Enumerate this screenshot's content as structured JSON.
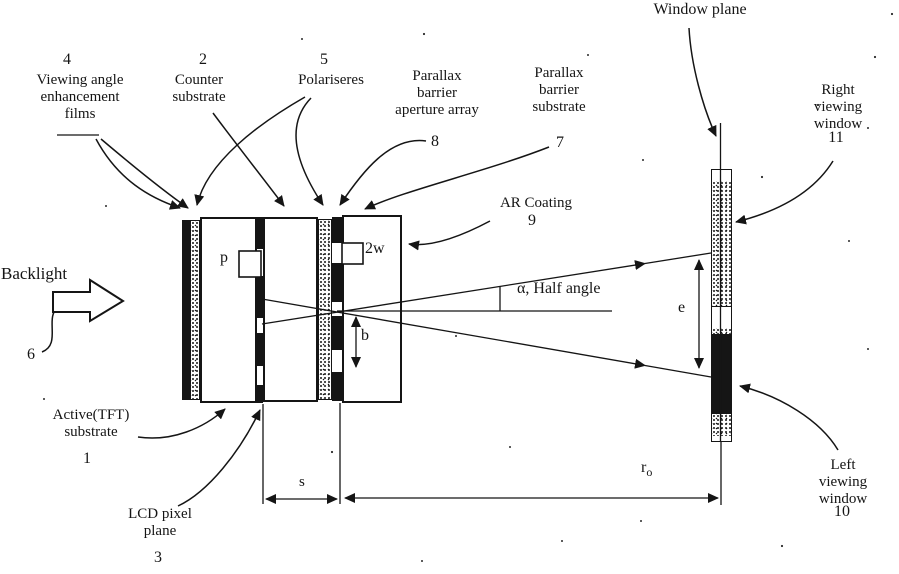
{
  "diagram": {
    "type": "patent-style optical diagram of parallax-barrier 3D display",
    "labels": {
      "window_plane": {
        "text": "Window plane"
      },
      "films": {
        "num": "4",
        "text": "Viewing angle\nenhancement\nfilms"
      },
      "counter_substrate": {
        "num": "2",
        "text": "Counter\nsubstrate"
      },
      "polarisers": {
        "num": "5",
        "text": "Polariseres"
      },
      "aperture_array": {
        "num": "8",
        "text": "Parallax\nbarrier\naperture array"
      },
      "barrier_substrate": {
        "num": "7",
        "text": "Parallax\nbarrier\nsubstrate"
      },
      "ar_coating": {
        "num": "9",
        "text": "AR Coating"
      },
      "right_window": {
        "num": "11",
        "text": "Right viewing\nwindow"
      },
      "left_window": {
        "num": "10",
        "text": "Left viewing\nwindow"
      },
      "backlight": {
        "num": "6",
        "text": "Backlight"
      },
      "tft_substrate": {
        "num": "1",
        "text": "Active(TFT)\nsubstrate"
      },
      "lcd_pixel_plane": {
        "num": "3",
        "text": "LCD pixel\nplane"
      }
    },
    "dimensions": {
      "pixel_pitch": "p",
      "aperture_width": "2w",
      "barrier_offset": "b",
      "eye_separation": "e",
      "barrier_separation": "s",
      "viewing_distance_base": "r",
      "viewing_distance_sub": "o",
      "half_angle": "α, Half angle"
    },
    "colors": {
      "ink": "#151515",
      "paper": "#ffffff"
    }
  }
}
